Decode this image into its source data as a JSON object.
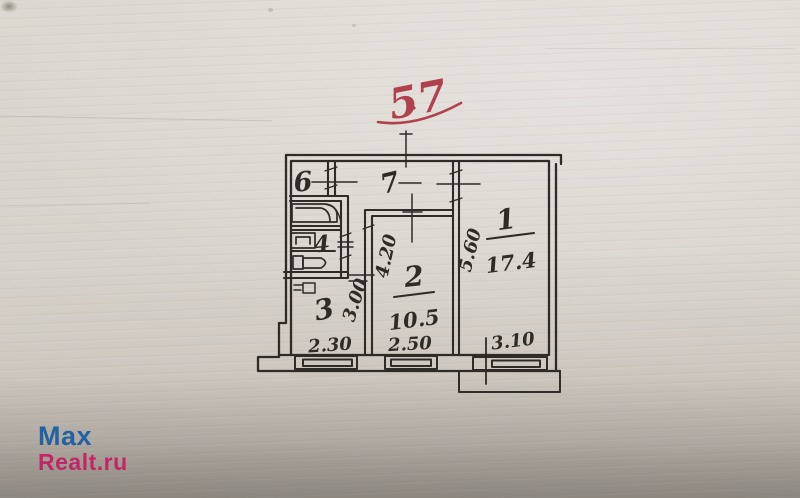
{
  "annotation": {
    "floor_number": "57",
    "ink_color": "#b0424d"
  },
  "floor_plan": {
    "ink_color": "#2f2b27",
    "rooms": {
      "r1": {
        "number": "1",
        "area": "17.4",
        "width": "3.10",
        "depth": "5.60"
      },
      "r2": {
        "number": "2",
        "area": "10.5",
        "width": "2.50",
        "depth": "4.20"
      },
      "r3": {
        "number": "3",
        "width": "2.30",
        "depth": "3.00"
      },
      "r4": {
        "number": "4"
      },
      "r6": {
        "number": "6"
      },
      "r7": {
        "number": "7"
      }
    }
  },
  "watermark": {
    "line1": "Max",
    "line2": "Realt.ru",
    "line1_color": "#1663b0",
    "line2_color": "#e2186e"
  }
}
